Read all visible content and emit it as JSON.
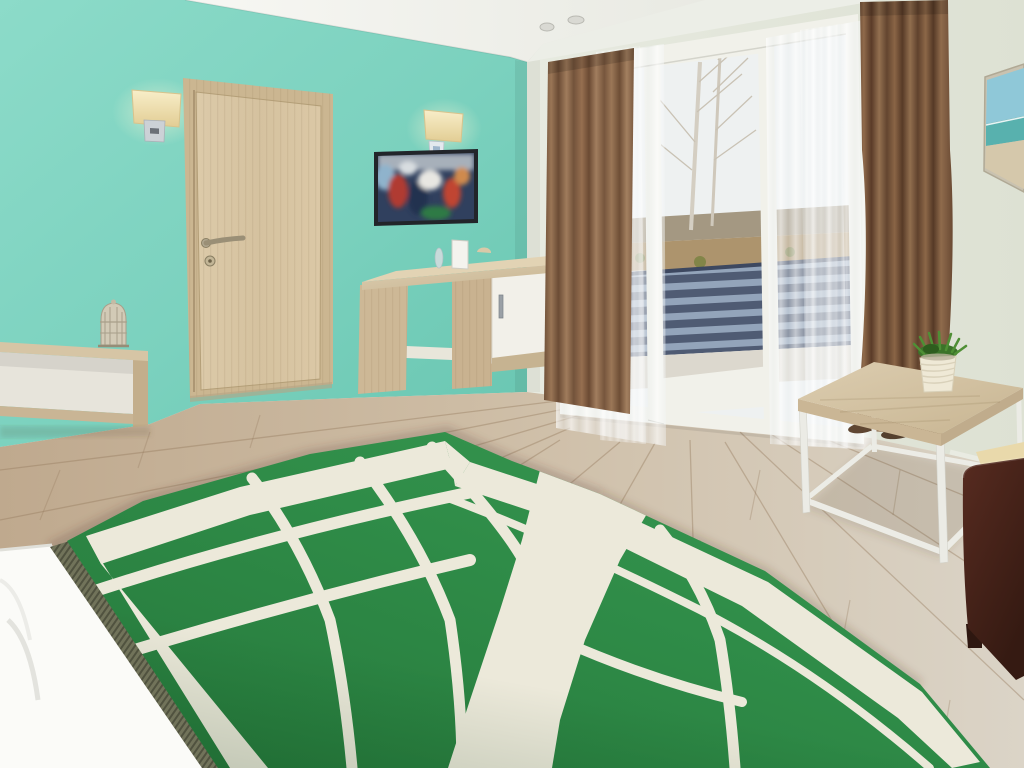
{
  "scene": {
    "label": "Hotel bedroom photo: teal accent wall, wood door, wall-mounted TV, desk, balcony window with brown curtains, coffee table with plant, bed with green and white geometric blanket"
  },
  "palette": {
    "pelmet": "#eceee7",
    "window_frame": "#f1f1ea",
    "door_frame": "#cbb691",
    "tv_frame": "#22252a",
    "cabinet": "#f2f0e9",
    "skirting": "#e8e6da",
    "pillow": "#fbfbf8",
    "cream": "#ece9da",
    "cushion": "#e9d9ab",
    "pot": "#efe9d6",
    "balcony_floor": "#dcd8ce",
    "hill": "#97886f",
    "brush": "#a5895e",
    "sky_view": "#eef1f1",
    "pic_sky": "#8fc8d8",
    "pic_sea": "#58b1ae",
    "pic_sand": "#d5c8ab",
    "chrome": "#ccd1d6",
    "decor": "#d0c8b3",
    "slipper": "#5c442f",
    "leg_white": "#ebebe5",
    "teal_mid": "#7bd1be",
    "blanket_green_mid": "#2f8c48",
    "curtain_brown_mid": "#8a6850",
    "floor_mid": "#cdbca4"
  },
  "objects": [
    {
      "id": "accent-wall",
      "label": "teal accent wall"
    },
    {
      "id": "entry-door",
      "label": "light wood door with lever handle"
    },
    {
      "id": "wall-lamp-left",
      "label": "rectangular cream wall sconce"
    },
    {
      "id": "wall-lamp-right",
      "label": "rectangular cream wall sconce"
    },
    {
      "id": "tv",
      "label": "wall-mounted television, colorful program"
    },
    {
      "id": "desk",
      "label": "light wood desk with white cabinet"
    },
    {
      "id": "bench-shelf",
      "label": "low open wood shelf with birdcage ornament"
    },
    {
      "id": "balcony-window",
      "label": "white balcony door and windows"
    },
    {
      "id": "curtains",
      "label": "brown blackout curtains with white sheers"
    },
    {
      "id": "beach-picture",
      "label": "beach seascape canvas"
    },
    {
      "id": "coffee-table",
      "label": "wood-top coffee table with white frame and potted plant"
    },
    {
      "id": "armchair",
      "label": "dark brown leather armchair with beige cushion"
    },
    {
      "id": "bed",
      "label": "bed with green and cream map-pattern blanket, fringe, white pillow"
    }
  ]
}
